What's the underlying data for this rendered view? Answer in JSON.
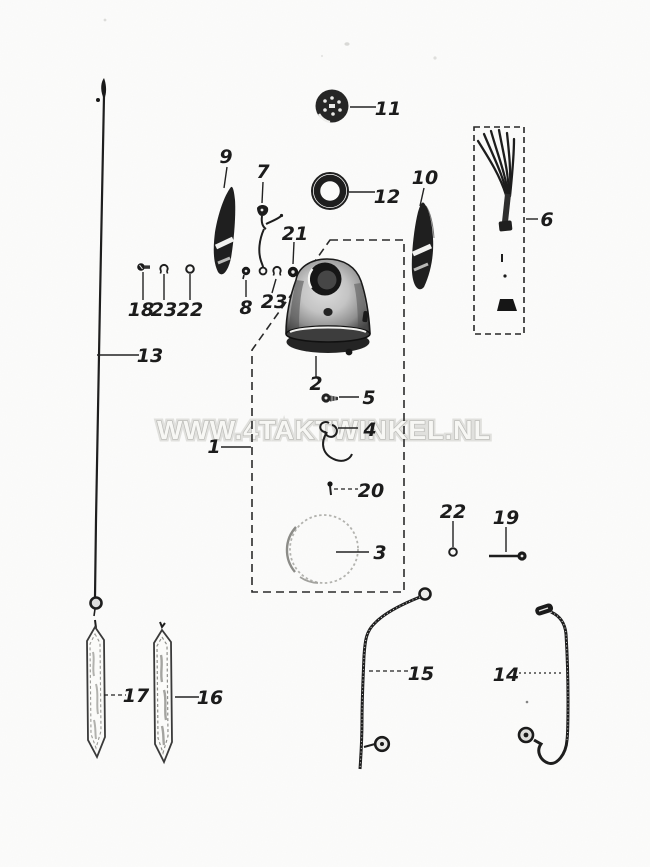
{
  "page": {
    "background_color": "#fcfcfb",
    "kind": "exploded-parts-diagram",
    "style": "black-and-white photocopy scan"
  },
  "watermark": {
    "text": "WWW.4TAKTWINKEL.NL",
    "fill_color": "#f7f7f4",
    "outline_color": "#b2b2ae"
  },
  "diagram": {
    "ink_color": "#1e1e1e",
    "subject": "headlamp and speedometer cable assembly",
    "part_labels": {
      "1": "1",
      "2": "2",
      "3": "3",
      "4": "4",
      "5": "5",
      "6": "6",
      "7": "7",
      "8": "8",
      "9": "9",
      "10": "10",
      "11": "11",
      "12": "12",
      "13": "13",
      "14": "14",
      "15": "15",
      "16": "16",
      "17": "17",
      "18": "18",
      "19": "19",
      "20": "20",
      "21": "21",
      "22": "22",
      "23": "23"
    },
    "callout_numbers": [
      "11",
      "9",
      "7",
      "12",
      "10",
      "6",
      "21",
      "18",
      "23",
      "22",
      "8",
      "23",
      "13",
      "2",
      "5",
      "4",
      "1",
      "20",
      "3",
      "22",
      "19",
      "15",
      "14",
      "17",
      "16"
    ]
  }
}
